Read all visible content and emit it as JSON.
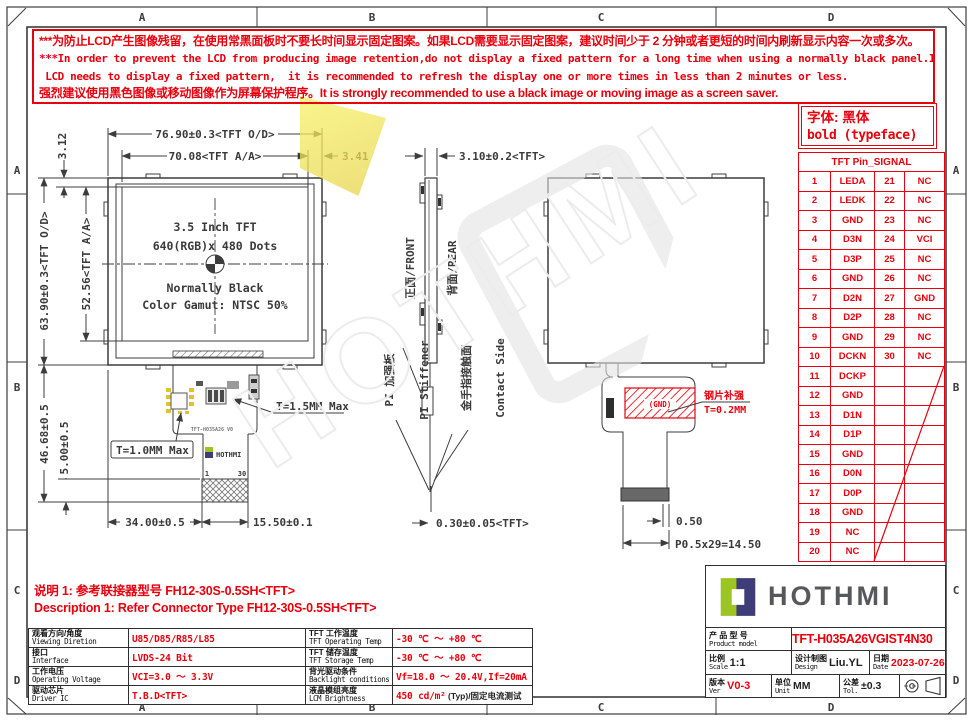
{
  "frame": {
    "top": [
      "A",
      "B",
      "C",
      "D"
    ],
    "bottom": [
      "A",
      "B",
      "C",
      "D"
    ],
    "left": [
      "A",
      "B",
      "C",
      "D"
    ],
    "right": [
      "A",
      "B",
      "C",
      "D"
    ]
  },
  "warning": {
    "line1": "***为防止LCD产生图像残留，在使用常黑面板时不要长时间显示固定图案。如果LCD需要显示固定图案，建议时间少于 2 分钟或者更短的时间内刷新显示内容一次或多次。",
    "line2": "***In order to prevent the LCD from producing image retention,do not display a fixed pattern for a long time when using a normally black panel.If the",
    "line3": " LCD needs to display a fixed pattern,  it is recommended to refresh the display one or more times in less than 2 minutes or less.",
    "line4": "强烈建议使用黑色图像或移动图像作为屏幕保护程序。It is strongly recommended to use a black image or moving image as a screen saver."
  },
  "font_note": {
    "line1": "字体: 黑体",
    "line2": "bold (typeface)"
  },
  "pin_table": {
    "title": "TFT Pin_SIGNAL",
    "rows": [
      [
        "1",
        "LEDA",
        "21",
        "NC"
      ],
      [
        "2",
        "LEDK",
        "22",
        "NC"
      ],
      [
        "3",
        "GND",
        "23",
        "NC"
      ],
      [
        "4",
        "D3N",
        "24",
        "VCI"
      ],
      [
        "5",
        "D3P",
        "25",
        "NC"
      ],
      [
        "6",
        "GND",
        "26",
        "NC"
      ],
      [
        "7",
        "D2N",
        "27",
        "GND"
      ],
      [
        "8",
        "D2P",
        "28",
        "NC"
      ],
      [
        "9",
        "GND",
        "29",
        "NC"
      ],
      [
        "10",
        "DCKN",
        "30",
        "NC"
      ],
      [
        "11",
        "DCKP",
        "",
        ""
      ],
      [
        "12",
        "GND",
        "",
        ""
      ],
      [
        "13",
        "D1N",
        "",
        ""
      ],
      [
        "14",
        "D1P",
        "",
        ""
      ],
      [
        "15",
        "GND",
        "",
        ""
      ],
      [
        "16",
        "D0N",
        "",
        ""
      ],
      [
        "17",
        "D0P",
        "",
        ""
      ],
      [
        "18",
        "GND",
        "",
        ""
      ],
      [
        "19",
        "NC",
        "",
        ""
      ],
      [
        "20",
        "NC",
        "",
        ""
      ]
    ]
  },
  "front_view": {
    "dim_od_w": "76.90±0.3<TFT O/D>",
    "dim_aa_w": "70.08<TFT A/A>",
    "dim_341": "3.41",
    "dim_312": "3.12",
    "dim_aa_h": "52.56<TFT A/A>",
    "dim_od_h": "63.90±0.3<TFT O/D>",
    "dim_4668": "46.68±0.5",
    "dim_500": "5.00±0.5",
    "t15": "T=1.5MM Max",
    "t10": "T=1.0MM Max",
    "dim_3400": "34.00±0.5",
    "dim_1550": "15.50±0.1",
    "line1": "3.5 Inch TFT",
    "line2": "640(RGB)x 480 Dots",
    "line3": "Normally Black",
    "line4": "Color Gamut: NTSC 50%",
    "pin1": "1",
    "pin30": "30",
    "fpc_label": "TFT-H035A26 V0",
    "fpc_logo": "HOTHMI"
  },
  "side_view": {
    "dim_310": "3.10±0.2<TFT>",
    "front_label": "正面/FRONT",
    "rear_label": "背面/REAR",
    "pi_cn": "PI 加强板",
    "pi_en": "PI Stiffener",
    "contact_cn": "金手指接触面",
    "contact_en": "Contact Side",
    "dim_030": "0.30±0.05<TFT>"
  },
  "rear_view": {
    "gnd": "(GND)",
    "stiff_cn": "钢片补强",
    "stiff_t": "T=0.2MM",
    "dim_050": "0.50",
    "dim_pitch": "P0.5x29=14.50"
  },
  "notes": {
    "line1": "说明 1: 参考联接器型号 FH12-30S-0.5SH<TFT>",
    "line2": "Description 1: Refer Connector Type FH12-30S-0.5SH<TFT>"
  },
  "spec_table": {
    "left": [
      {
        "cn": "观看方向/角度",
        "en": "Viewing Diretion",
        "val": "U85/D85/R85/L85"
      },
      {
        "cn": "接口",
        "en": "Interface",
        "val": "LVDS-24 Bit"
      },
      {
        "cn": "工作电压",
        "en": "Operating Voltage",
        "val": "VCI=3.0 ～ 3.3V"
      },
      {
        "cn": "驱动芯片",
        "en": "Driver IC",
        "val": "T.B.D<TFT>"
      }
    ],
    "right": [
      {
        "cn": "TFT 工作温度",
        "en": "TFT Operating Temp",
        "val": "-30 ℃ ～ +80 ℃",
        "val2": ""
      },
      {
        "cn": "TFT 储存温度",
        "en": "TFT Storage Temp",
        "val": "-30 ℃ ～ +80 ℃",
        "val2": ""
      },
      {
        "cn": "背光驱动条件",
        "en": "Backlight conditions",
        "val": "Vf=18.0 ～ 20.4V,If=20mA",
        "val2": ""
      },
      {
        "cn": "液晶模组亮度",
        "en": "LCM Brightness",
        "val": "450 cd/m²",
        "val2": " (Typ)/固定电流测试"
      }
    ]
  },
  "title_block": {
    "logo_text": "HOTHMI",
    "product_label_cn": "产 品 型 号",
    "product_label_en": "Product model",
    "product_value": "TFT-H035A26VGIST4N30",
    "scale_cn": "比例",
    "scale_en": "Scale",
    "scale_val": "1:1",
    "design_cn": "设计制图",
    "design_en": "Design",
    "design_val": "Liu.YL",
    "date_cn": "日期",
    "date_en": "Date",
    "date_val": "2023-07-26",
    "ver_cn": "版本",
    "ver_en": "Ver",
    "ver_val": "V0-3",
    "unit_cn": "单位",
    "unit_en": "Unit",
    "unit_val": "MM",
    "tol_cn": "公差",
    "tol_en": "Tol.",
    "tol_val": "±0.3"
  },
  "watermark": {
    "text": "HOTHMI"
  }
}
